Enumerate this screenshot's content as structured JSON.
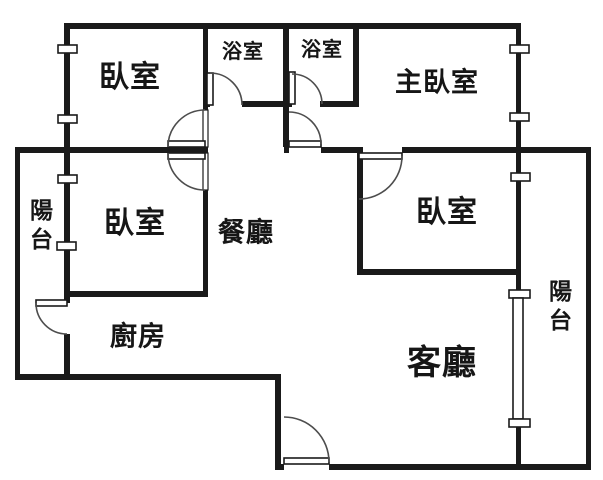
{
  "rooms": {
    "bedroom_top_left": "臥室",
    "bathroom_left": "浴室",
    "bathroom_right": "浴室",
    "master_bedroom": "主臥室",
    "bedroom_mid_left": "臥室",
    "dining_room": "餐廳",
    "bedroom_right": "臥室",
    "kitchen": "廚房",
    "living_room": "客廳",
    "balcony_left": "陽台",
    "balcony_right": "陽台"
  },
  "colors": {
    "wall": "#1a1a1a",
    "door_arc": "#4d4d4d",
    "background": "#ffffff"
  }
}
